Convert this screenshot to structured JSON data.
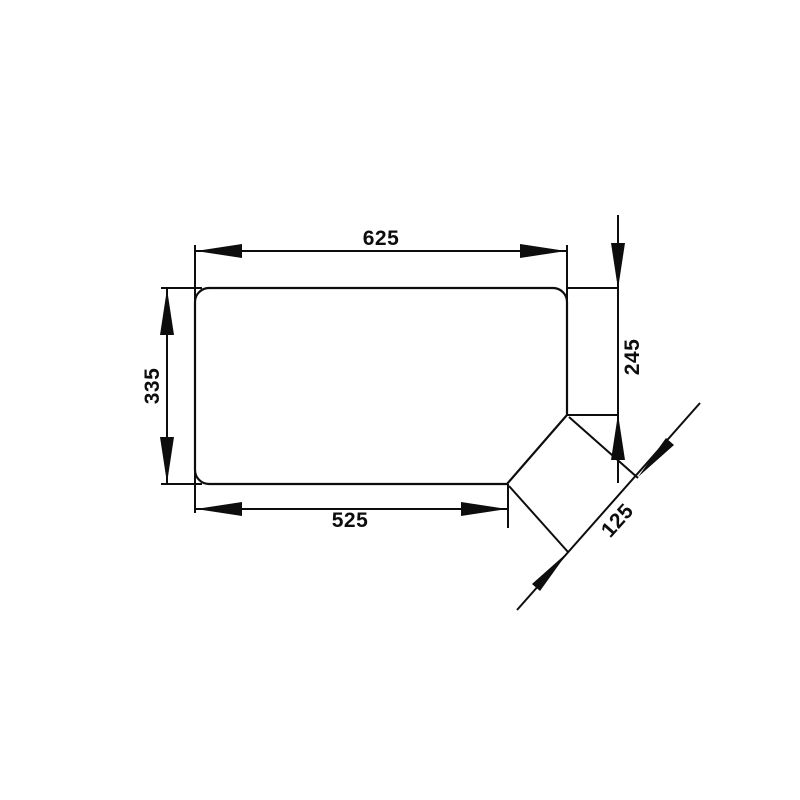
{
  "drawing": {
    "kind": "technical-dimension-drawing",
    "subject": "panel-outline-with-corner-cut",
    "background_color": "#ffffff",
    "line_color": "#0d0d0d",
    "dimensions": {
      "top_width": "625",
      "left_height": "335",
      "right_height": "245",
      "bottom_width": "525",
      "corner_cut": "125"
    }
  }
}
